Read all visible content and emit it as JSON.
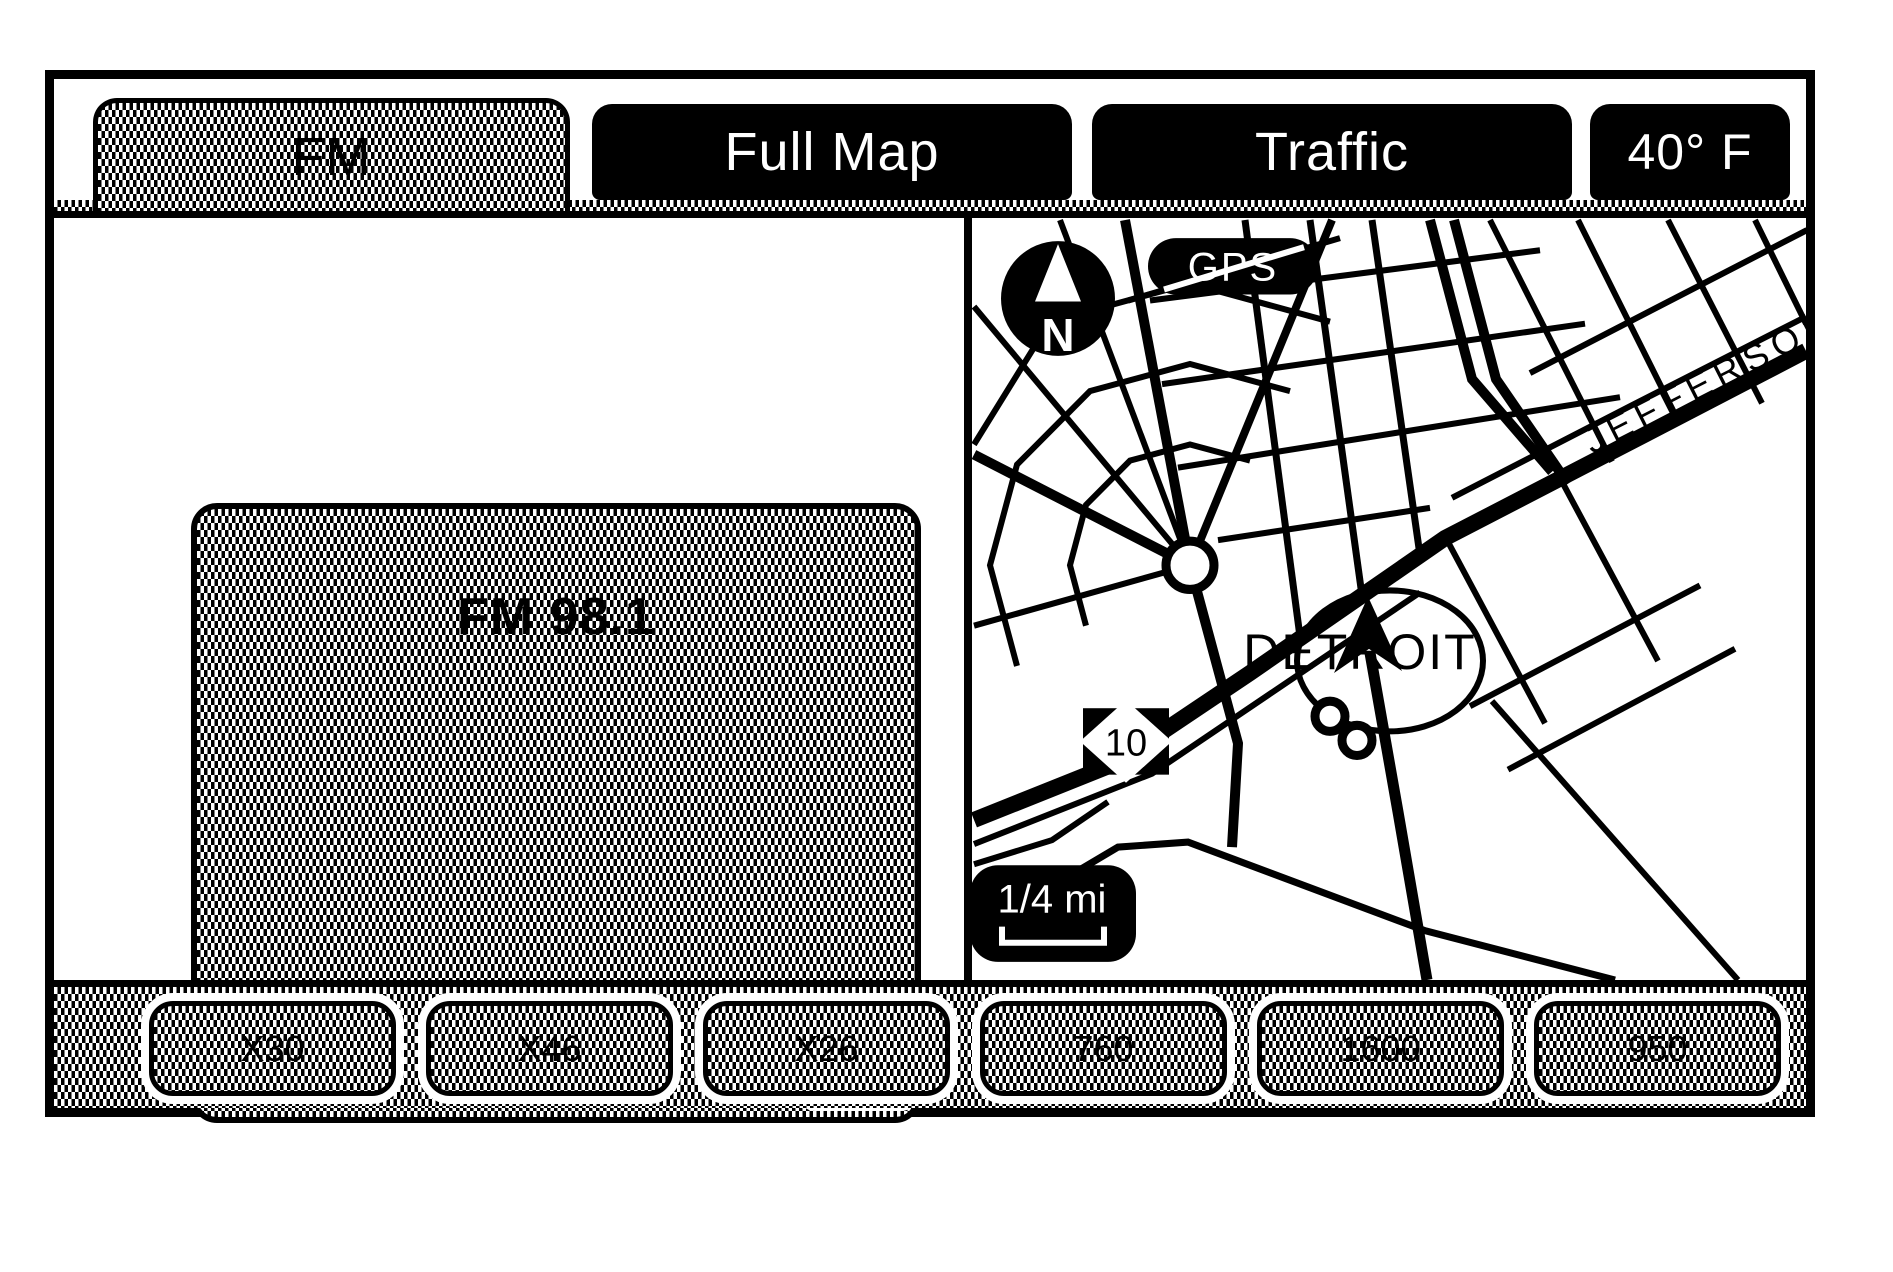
{
  "tabs": {
    "fm": "FM",
    "full_map": "Full Map",
    "traffic": "Traffic",
    "temperature": "40° F"
  },
  "radio": {
    "station": "FM 98.1",
    "favorite_badge": "FAV 1"
  },
  "map": {
    "compass_north": "N",
    "gps_label": "GPS",
    "city_label": "DETROIT",
    "street_label": "JEFFERSON",
    "highway_shield": "10",
    "scale_label": "1/4 mi"
  },
  "presets": [
    "X30",
    "X46",
    "X26",
    "760",
    "1600",
    "950"
  ],
  "colors": {
    "ink": "#000000",
    "paper": "#ffffff"
  }
}
